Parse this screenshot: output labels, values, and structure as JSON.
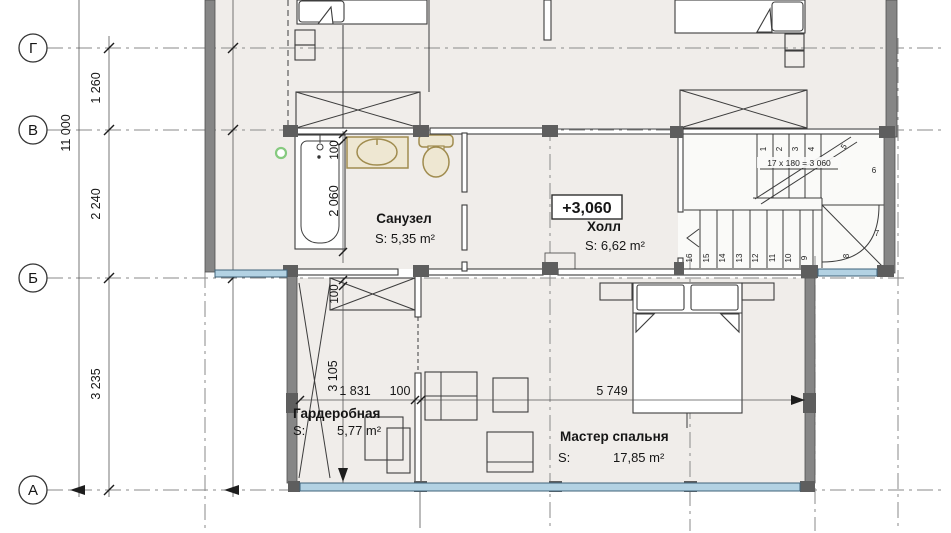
{
  "plan": {
    "axes": {
      "row_g": "Г",
      "row_v": "В",
      "row_b": "Б",
      "row_a": "А"
    },
    "dimensions": {
      "overall_height": "11 000",
      "g_to_v": "1 260",
      "v_to_b": "2 240",
      "b_to_a": "3 235",
      "tub_offset": "100",
      "tub_length": "2 060",
      "wardrobe_offset": "100",
      "wardrobe_depth": "3 105",
      "wardrobe_width": "1 831",
      "wall_thickness": "100",
      "bedroom_width": "5 749"
    },
    "rooms": {
      "bathroom": {
        "name": "Санузел",
        "area": "S: 5,35 m²"
      },
      "hall": {
        "name": "Холл",
        "area": "S: 6,62 m²",
        "elevation": "+3,060"
      },
      "wardrobe": {
        "name": "Гардеробная",
        "area_prefix": "S:",
        "area": "5,77 m²"
      },
      "master": {
        "name": "Мастер спальня",
        "area_prefix": "S:",
        "area": "17,85 m²"
      }
    },
    "stairs": {
      "formula": "17 x 180 = 3 060",
      "numbers": [
        "1",
        "2",
        "3",
        "4",
        "5",
        "6",
        "7",
        "8",
        "9",
        "10",
        "11",
        "12",
        "13",
        "14",
        "15",
        "16"
      ]
    },
    "colors": {
      "wall_gray": "#868686",
      "window_blue": "#b3d2e3",
      "fixture_tan": "#a08c4f",
      "room_fill": "#f0edea",
      "grid_line": "#8a8a8a",
      "accent_green": "#86ca7f"
    }
  }
}
